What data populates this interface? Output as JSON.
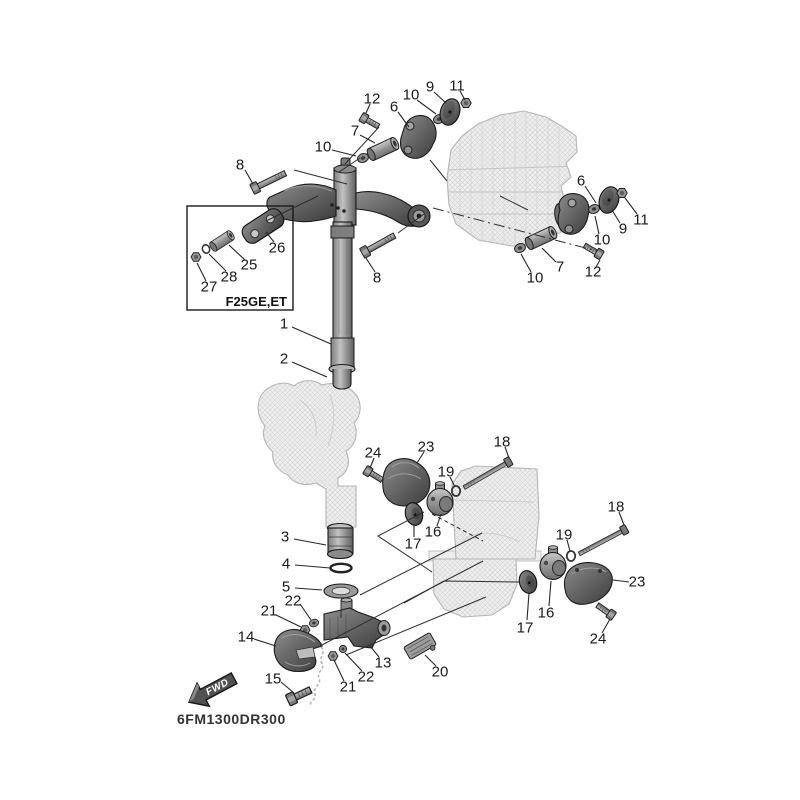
{
  "diagram": {
    "title_code": "6FM1300DR300",
    "inset": {
      "label": "F25GE,ET",
      "x": 187,
      "y": 206,
      "w": 106,
      "h": 104,
      "label_x": 287,
      "label_y": 306
    },
    "fwd": {
      "label": "FWD",
      "x": 212,
      "y": 690,
      "angle": -28
    },
    "callouts": [
      {
        "id": "1",
        "n": "1",
        "x": 284,
        "y": 324,
        "leader": [
          [
            292,
            327
          ],
          [
            331,
            344
          ]
        ]
      },
      {
        "id": "2",
        "n": "2",
        "x": 284,
        "y": 359,
        "leader": [
          [
            292,
            362
          ],
          [
            327,
            377
          ]
        ]
      },
      {
        "id": "3",
        "n": "3",
        "x": 285,
        "y": 537,
        "leader": [
          [
            294,
            539
          ],
          [
            326,
            545
          ]
        ]
      },
      {
        "id": "4",
        "n": "4",
        "x": 286,
        "y": 564,
        "leader": [
          [
            295,
            565
          ],
          [
            330,
            568
          ]
        ]
      },
      {
        "id": "5",
        "n": "5",
        "x": 286,
        "y": 587,
        "leader": [
          [
            295,
            588
          ],
          [
            322,
            590
          ]
        ]
      },
      {
        "id": "6L",
        "n": "6",
        "x": 394,
        "y": 107,
        "leader": [
          [
            398,
            112
          ],
          [
            409,
            127
          ]
        ]
      },
      {
        "id": "6R",
        "n": "6",
        "x": 581,
        "y": 181,
        "leader": [
          [
            585,
            186
          ],
          [
            596,
            203
          ]
        ]
      },
      {
        "id": "7L",
        "n": "7",
        "x": 355,
        "y": 131,
        "leader": [
          [
            360,
            135
          ],
          [
            375,
            143
          ]
        ]
      },
      {
        "id": "7R",
        "n": "7",
        "x": 560,
        "y": 267,
        "leader": [
          [
            556,
            262
          ],
          [
            542,
            248
          ]
        ]
      },
      {
        "id": "8L",
        "n": "8",
        "x": 240,
        "y": 165,
        "leader": [
          [
            245,
            170
          ],
          [
            253,
            184
          ]
        ]
      },
      {
        "id": "8R",
        "n": "8",
        "x": 377,
        "y": 278,
        "leader": [
          [
            375,
            272
          ],
          [
            366,
            258
          ]
        ]
      },
      {
        "id": "9L",
        "n": "9",
        "x": 430,
        "y": 87,
        "leader": [
          [
            434,
            92
          ],
          [
            446,
            103
          ]
        ]
      },
      {
        "id": "9R",
        "n": "9",
        "x": 623,
        "y": 229,
        "leader": [
          [
            620,
            223
          ],
          [
            612,
            210
          ]
        ]
      },
      {
        "id": "10La",
        "n": "10",
        "x": 323,
        "y": 147,
        "leader": [
          [
            332,
            150
          ],
          [
            356,
            156
          ]
        ]
      },
      {
        "id": "10Lb",
        "n": "10",
        "x": 411,
        "y": 95,
        "leader": [
          [
            417,
            100
          ],
          [
            436,
            114
          ]
        ]
      },
      {
        "id": "10Ra",
        "n": "10",
        "x": 602,
        "y": 240,
        "leader": [
          [
            599,
            234
          ],
          [
            595,
            216
          ]
        ]
      },
      {
        "id": "10Rb",
        "n": "10",
        "x": 535,
        "y": 278,
        "leader": [
          [
            531,
            272
          ],
          [
            521,
            254
          ]
        ]
      },
      {
        "id": "11L",
        "n": "11",
        "x": 457,
        "y": 86,
        "leader": [
          [
            460,
            91
          ],
          [
            465,
            100
          ]
        ]
      },
      {
        "id": "11R",
        "n": "11",
        "x": 641,
        "y": 220,
        "leader": [
          [
            637,
            214
          ],
          [
            625,
            198
          ]
        ]
      },
      {
        "id": "12L",
        "n": "12",
        "x": 372,
        "y": 99,
        "leader": [
          [
            370,
            104
          ],
          [
            366,
            113
          ]
        ]
      },
      {
        "id": "12R",
        "n": "12",
        "x": 593,
        "y": 272,
        "leader": [
          [
            596,
            267
          ],
          [
            600,
            260
          ]
        ]
      },
      {
        "id": "13",
        "n": "13",
        "x": 383,
        "y": 663,
        "leader": [
          [
            379,
            657
          ],
          [
            370,
            646
          ]
        ]
      },
      {
        "id": "14",
        "n": "14",
        "x": 246,
        "y": 637,
        "leader": [
          [
            254,
            639
          ],
          [
            276,
            646
          ]
        ]
      },
      {
        "id": "15",
        "n": "15",
        "x": 273,
        "y": 679,
        "leader": [
          [
            281,
            682
          ],
          [
            294,
            693
          ]
        ]
      },
      {
        "id": "16L",
        "n": "16",
        "x": 433,
        "y": 532,
        "leader": [
          [
            437,
            526
          ],
          [
            441,
            514
          ]
        ]
      },
      {
        "id": "16R",
        "n": "16",
        "x": 546,
        "y": 613,
        "leader": [
          [
            549,
            606
          ],
          [
            551,
            581
          ]
        ]
      },
      {
        "id": "17L",
        "n": "17",
        "x": 413,
        "y": 544,
        "leader": [
          [
            414,
            537
          ],
          [
            414,
            524
          ]
        ]
      },
      {
        "id": "17R",
        "n": "17",
        "x": 525,
        "y": 628,
        "leader": [
          [
            527,
            620
          ],
          [
            529,
            593
          ]
        ]
      },
      {
        "id": "18L",
        "n": "18",
        "x": 502,
        "y": 442,
        "leader": [
          [
            505,
            447
          ],
          [
            509,
            458
          ]
        ]
      },
      {
        "id": "18R",
        "n": "18",
        "x": 616,
        "y": 507,
        "leader": [
          [
            619,
            512
          ],
          [
            624,
            525
          ]
        ]
      },
      {
        "id": "19L",
        "n": "19",
        "x": 446,
        "y": 472,
        "leader": [
          [
            450,
            477
          ],
          [
            455,
            487
          ]
        ]
      },
      {
        "id": "19R",
        "n": "19",
        "x": 564,
        "y": 535,
        "leader": [
          [
            567,
            540
          ],
          [
            570,
            551
          ]
        ]
      },
      {
        "id": "20",
        "n": "20",
        "x": 440,
        "y": 672,
        "leader": [
          [
            436,
            666
          ],
          [
            425,
            655
          ]
        ]
      },
      {
        "id": "21a",
        "n": "21",
        "x": 269,
        "y": 611,
        "leader": [
          [
            276,
            615
          ],
          [
            301,
            627
          ]
        ]
      },
      {
        "id": "21b",
        "n": "21",
        "x": 348,
        "y": 687,
        "leader": [
          [
            344,
            681
          ],
          [
            334,
            660
          ]
        ]
      },
      {
        "id": "22a",
        "n": "22",
        "x": 293,
        "y": 601,
        "leader": [
          [
            300,
            604
          ],
          [
            311,
            620
          ]
        ]
      },
      {
        "id": "22b",
        "n": "22",
        "x": 366,
        "y": 677,
        "leader": [
          [
            362,
            671
          ],
          [
            345,
            653
          ]
        ]
      },
      {
        "id": "23L",
        "n": "23",
        "x": 426,
        "y": 447,
        "leader": [
          [
            424,
            452
          ],
          [
            417,
            463
          ]
        ]
      },
      {
        "id": "23R",
        "n": "23",
        "x": 637,
        "y": 582,
        "leader": [
          [
            629,
            582
          ],
          [
            613,
            580
          ]
        ]
      },
      {
        "id": "24L",
        "n": "24",
        "x": 373,
        "y": 453,
        "leader": [
          [
            374,
            458
          ],
          [
            370,
            468
          ]
        ]
      },
      {
        "id": "24R",
        "n": "24",
        "x": 598,
        "y": 639,
        "leader": [
          [
            602,
            633
          ],
          [
            610,
            619
          ]
        ]
      },
      {
        "id": "25",
        "n": "25",
        "x": 249,
        "y": 265,
        "leader": [
          [
            245,
            260
          ],
          [
            229,
            245
          ]
        ]
      },
      {
        "id": "26",
        "n": "26",
        "x": 277,
        "y": 248,
        "leader": [
          [
            274,
            242
          ],
          [
            266,
            232
          ]
        ]
      },
      {
        "id": "27",
        "n": "27",
        "x": 209,
        "y": 287,
        "leader": [
          [
            206,
            281
          ],
          [
            197,
            263
          ]
        ]
      },
      {
        "id": "28",
        "n": "28",
        "x": 229,
        "y": 277,
        "leader": [
          [
            226,
            271
          ],
          [
            209,
            254
          ]
        ]
      }
    ],
    "lines": [
      {
        "pts": [
          [
            294,
            170
          ],
          [
            347,
            184
          ]
        ]
      },
      {
        "pts": [
          [
            360,
            158
          ],
          [
            339,
            172
          ]
        ]
      },
      {
        "pts": [
          [
            379,
            127
          ],
          [
            345,
            164
          ]
        ]
      },
      {
        "pts": [
          [
            430,
            160
          ],
          [
            447,
            181
          ]
        ]
      },
      {
        "pts": [
          [
            433,
            208
          ],
          [
            597,
            251
          ]
        ],
        "dash": "11 4 2 4"
      },
      {
        "pts": [
          [
            398,
            233
          ],
          [
            424,
            214
          ]
        ]
      },
      {
        "pts": [
          [
            528,
            210
          ],
          [
            500,
            196
          ]
        ]
      },
      {
        "pts": [
          [
            266,
            221
          ],
          [
            318,
            196
          ]
        ]
      },
      {
        "pts": [
          [
            432,
            514
          ],
          [
            483,
            541
          ]
        ],
        "dash": "4 3"
      },
      {
        "pts": [
          [
            424,
            512
          ],
          [
            378,
            536
          ],
          [
            432,
            572
          ]
        ]
      },
      {
        "pts": [
          [
            519,
            582
          ],
          [
            444,
            581
          ],
          [
            404,
            603
          ]
        ]
      },
      {
        "pts": [
          [
            320,
            646
          ],
          [
            483,
            561
          ]
        ]
      },
      {
        "pts": [
          [
            346,
            655
          ],
          [
            486,
            597
          ]
        ]
      },
      {
        "pts": [
          [
            360,
            595
          ],
          [
            482,
            533
          ]
        ]
      },
      {
        "pts": [
          [
            341,
            600
          ],
          [
            341,
            618
          ]
        ]
      }
    ]
  }
}
